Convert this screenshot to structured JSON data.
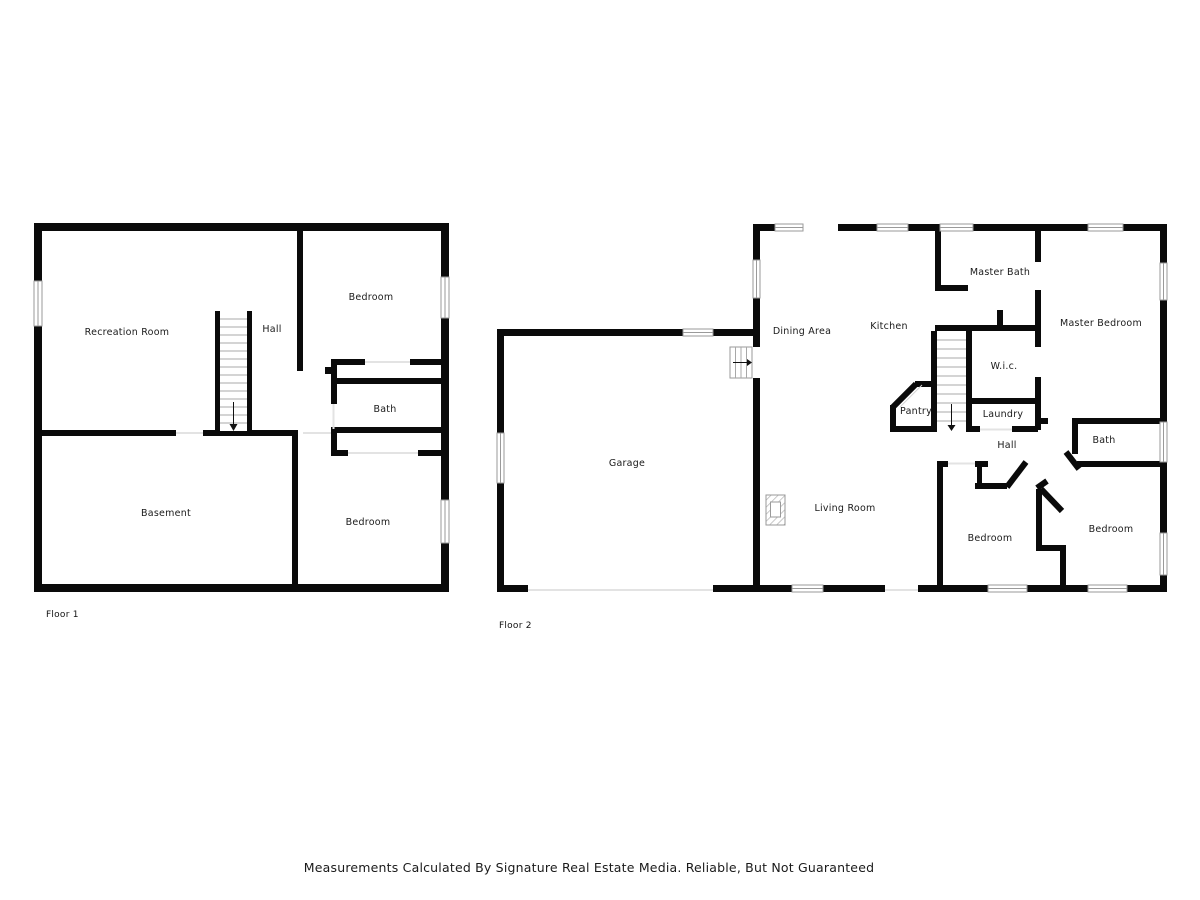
{
  "floor1": {
    "label": "Floor 1",
    "rooms": {
      "recreation_room": "Recreation Room",
      "hall": "Hall",
      "bedroom_top": "Bedroom",
      "bath": "Bath",
      "basement": "Basement",
      "bedroom_bottom": "Bedroom"
    }
  },
  "floor2": {
    "label": "Floor 2",
    "rooms": {
      "dining_area": "Dining Area",
      "kitchen": "Kitchen",
      "master_bath": "Master Bath",
      "master_bedroom": "Master Bedroom",
      "wic": "W.i.c.",
      "pantry": "Pantry",
      "laundry": "Laundry",
      "hall": "Hall",
      "bath": "Bath",
      "garage": "Garage",
      "living_room": "Living Room",
      "bedroom_center": "Bedroom",
      "bedroom_right": "Bedroom"
    }
  },
  "footer": {
    "text": "Measurements Calculated By Signature Real Estate Media. Reliable, But Not Guaranteed"
  },
  "colors": {
    "wall": "#0a0a0a",
    "window_outline": "#9a9a9a",
    "stair_tread": "#a8a8a8",
    "door_opening_line": "#e3e3e3",
    "label_text": "#1a1a1a"
  }
}
